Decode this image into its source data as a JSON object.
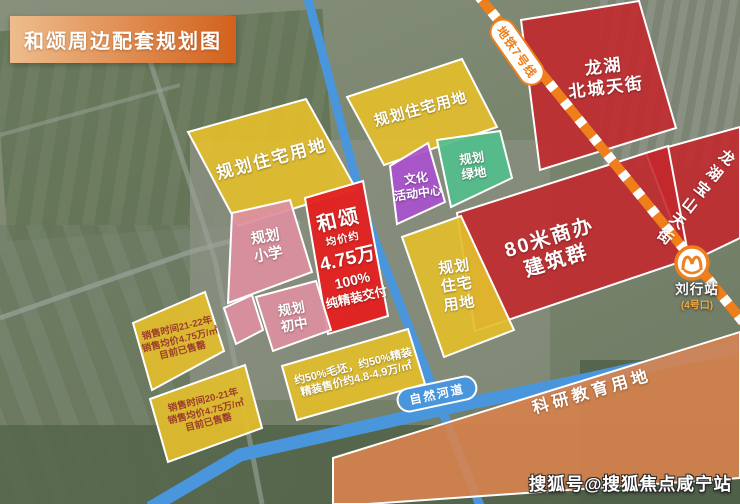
{
  "title": "和颂周边配套规划图",
  "metro": {
    "line_label": "地铁7号线",
    "station": "刘行站",
    "exit": "(4号口)",
    "line_color": "#ef7f1a"
  },
  "river_label": "自然河道",
  "watermark": "搜狐号@搜狐焦点咸宁站",
  "colors": {
    "residential_yellow": "#e2bd2d",
    "school_pink": "#dd8f9f",
    "commercial_red": "#c4272c",
    "hesong_red": "#e32120",
    "culture_purple": "#aa52cc",
    "green_space": "#54bd8c",
    "research_orange": "#d8834e",
    "road_blue": "#4a96dd",
    "banner_from": "#eebd8d",
    "banner_to": "#d2611c"
  },
  "blocks": {
    "res_a": {
      "lines": [
        "规划住宅用地"
      ]
    },
    "res_b": {
      "lines": [
        "规划住宅用地"
      ]
    },
    "res_c": {
      "lines": [
        "规划",
        "住宅",
        "用地"
      ]
    },
    "culture": {
      "lines": [
        "文化",
        "活动中心"
      ]
    },
    "greenland": {
      "lines": [
        "规划",
        "绿地"
      ]
    },
    "hesong": {
      "lines": [
        "和颂",
        "均价约",
        "4.75万",
        "100%",
        "纯精装交付"
      ]
    },
    "primary_school": {
      "lines": [
        "规划",
        "小学"
      ]
    },
    "middle_school": {
      "lines": [
        "规划",
        "初中"
      ]
    },
    "decor_info": {
      "lines": [
        "约50%毛坯，约50%精装",
        "精装售价约4.8-4.9万/㎡"
      ]
    },
    "sold_1": {
      "lines": [
        "销售时间21-22年",
        "销售均价4.75万/㎡",
        "目前已售罄"
      ]
    },
    "sold_2": {
      "lines": [
        "销售时间20-21年",
        "销售均价4.75万/㎡",
        "目前已售罄"
      ]
    },
    "beicheng": {
      "lines": [
        "龙湖",
        "北城天街"
      ]
    },
    "shangban": {
      "lines": [
        "80米商办",
        "建筑群"
      ]
    },
    "baoshan": {
      "lines": [
        "龙湖宝山天街"
      ]
    },
    "research": {
      "lines": [
        "科研教育用地"
      ]
    }
  }
}
